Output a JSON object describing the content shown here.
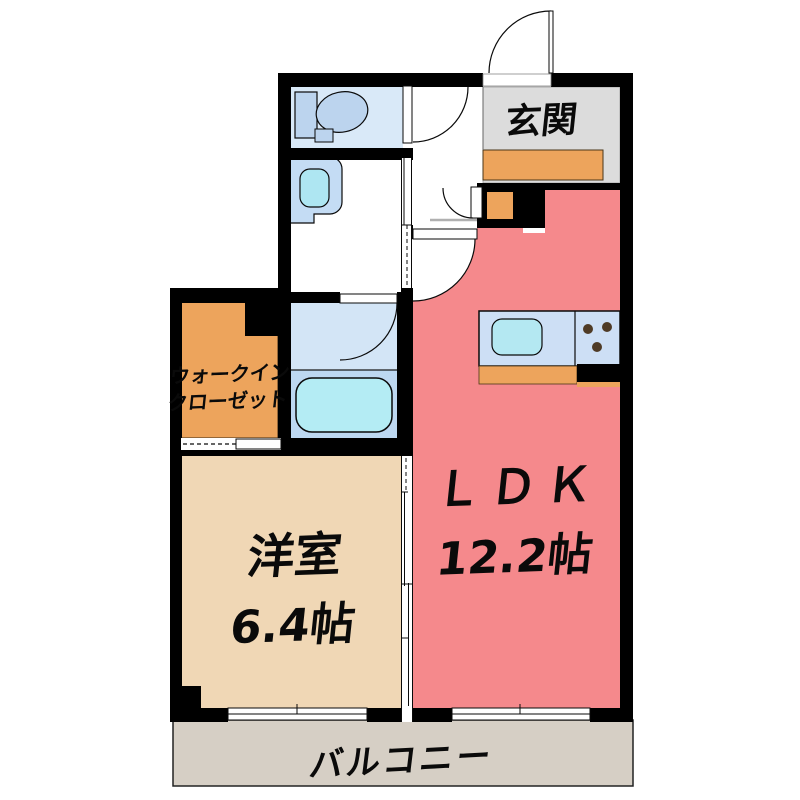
{
  "plan": {
    "rooms": {
      "genkan": {
        "label": "玄関"
      },
      "ldk": {
        "label": "ＬＤＫ",
        "size": "12.2帖"
      },
      "western": {
        "label": "洋室",
        "size": "6.4帖"
      },
      "wic": {
        "line1": "ウォークイン",
        "line2": "クローゼット"
      },
      "balcony": {
        "label": "バルコニー"
      }
    },
    "colors": {
      "wall": "#000000",
      "ldk": "#f5898c",
      "western": "#f0d7b5",
      "wic": "#eda45c",
      "genkan_floor": "#dcdcdc",
      "step": "#eda45c",
      "balcony": "#d6cfc5",
      "toilet_room": "#d9e9f8",
      "fixture_blue": "#bcd4ee",
      "basin": "#c4dcf4",
      "sink_cyan": "#aee6f2",
      "bath_floor": "#d3e5f6",
      "bath_tub_area": "#bdd8f1",
      "tub": "#b4ecf4",
      "counter": "#cddff5",
      "kitchen_sink": "#b4e8f2",
      "burner": "#4f3b26"
    }
  }
}
